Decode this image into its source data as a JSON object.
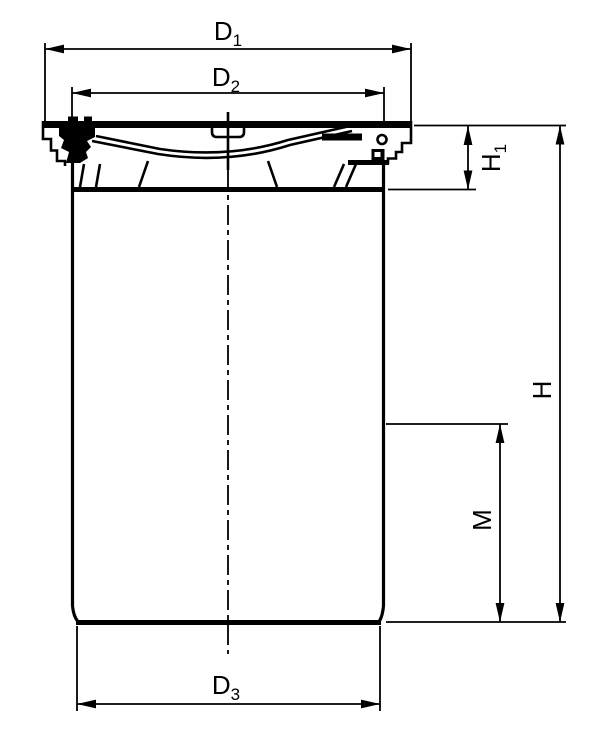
{
  "drawing": {
    "background": "#ffffff",
    "line_color": "#000000",
    "labels": {
      "d1": {
        "base": "D",
        "sub": "1"
      },
      "d2": {
        "base": "D",
        "sub": "2"
      },
      "d3": {
        "base": "D",
        "sub": "3"
      },
      "h": {
        "base": "H",
        "sub": ""
      },
      "h1": {
        "base": "H",
        "sub": "1"
      },
      "m": {
        "base": "M",
        "sub": ""
      }
    }
  }
}
